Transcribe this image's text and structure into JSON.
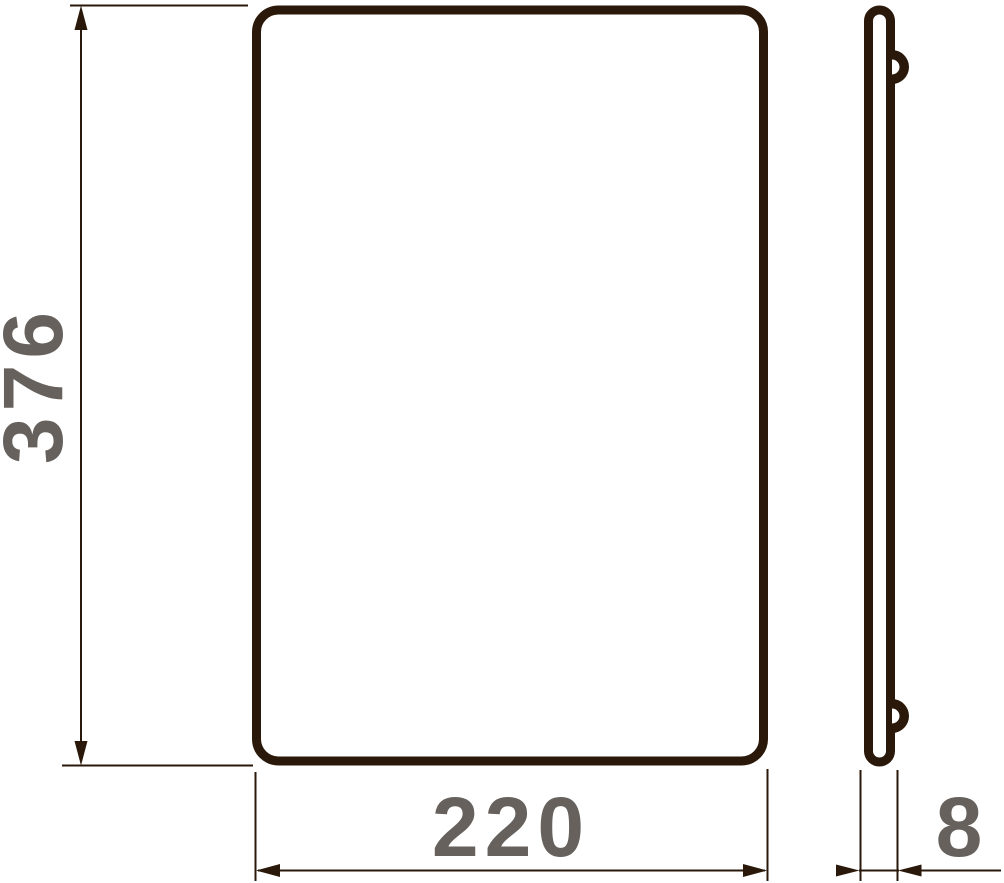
{
  "drawing": {
    "kind": "technical-dimension-drawing",
    "views": [
      {
        "id": "front-view",
        "shape": "rounded-rectangle"
      },
      {
        "id": "side-view",
        "shape": "thin-profile-with-two-hooks"
      }
    ]
  },
  "dimensions": {
    "height": {
      "value": "376"
    },
    "width": {
      "value": "220"
    },
    "thickness": {
      "value": "8"
    }
  },
  "colors": {
    "outline": "#2a190a",
    "dimension_lines": "#2a190a",
    "label_text": "#66615c",
    "background": "#ffffff"
  }
}
